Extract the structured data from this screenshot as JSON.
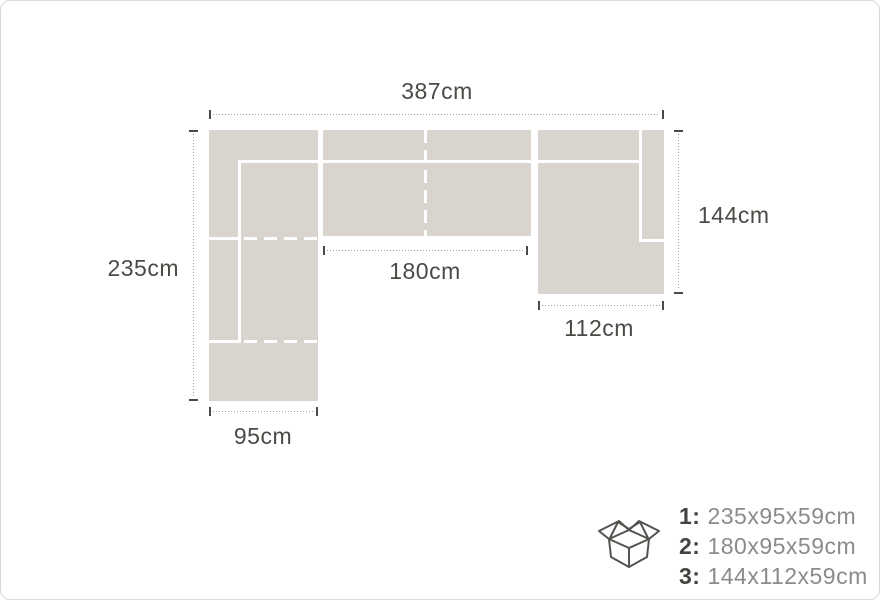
{
  "colors": {
    "sofa_fill": "#dad4ce",
    "seam_line": "#ffffff",
    "dim_dotted_line": "#a3a09b",
    "dim_tick_and_text": "#4d4a46",
    "package_number_text": "#45433f",
    "package_value_text": "#8d8b88"
  },
  "sofa_diagram": {
    "overall_width_label": "387cm",
    "left_depth_label": "235cm",
    "right_depth_label": "144cm",
    "middle_width_label": "180cm",
    "right_width_label": "112cm",
    "left_width_label": "95cm"
  },
  "packages": {
    "icon": "open-box-icon",
    "items": [
      {
        "num": "1:",
        "size": "235x95x59cm"
      },
      {
        "num": "2:",
        "size": "180x95x59cm"
      },
      {
        "num": "3:",
        "size": "144x112x59cm"
      }
    ]
  }
}
